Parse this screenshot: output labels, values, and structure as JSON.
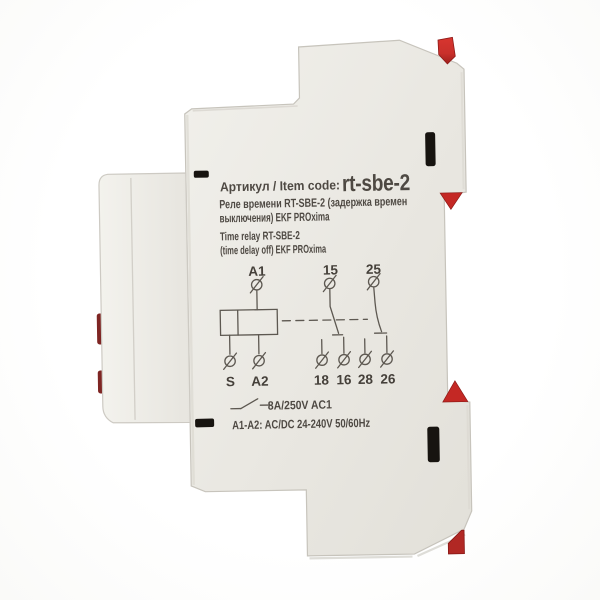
{
  "labels": {
    "artikul": "Артикул / Item code:",
    "item_code": "rt-sbe-2",
    "desc_ru": [
      "Реле времени RT-SBE-2 (задержка времен",
      "выключения) EKF PROxima"
    ],
    "desc_en": [
      "Time relay RT-SBE-2",
      "(time delay off) EKF PROxima"
    ],
    "contact_rating": "8A/250V AC1",
    "supply_rating": "A1-A2: AC/DC 24-240V 50/60Hz"
  },
  "diagram": {
    "top_terminals": [
      "A1",
      "15",
      "25"
    ],
    "bottom_terminals": [
      "S",
      "A2",
      "18",
      "16",
      "28",
      "26"
    ]
  },
  "colors": {
    "body_gray": "#e9e7e1",
    "clip_red": "#c9302b",
    "slot_black": "#171410",
    "print_ink": "#4e4943"
  }
}
